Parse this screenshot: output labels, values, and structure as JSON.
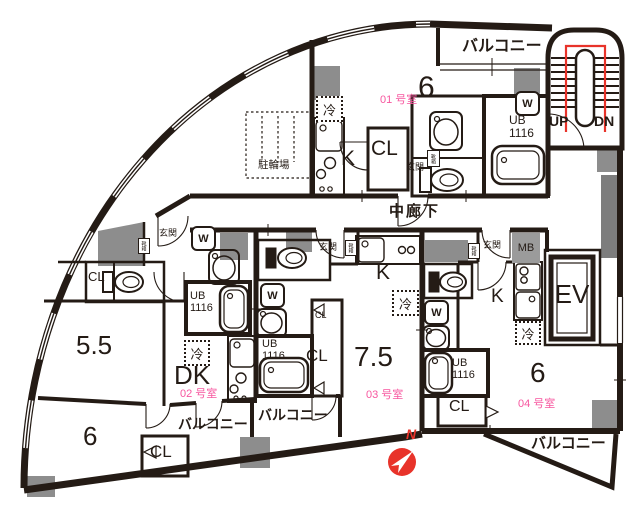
{
  "colors": {
    "wall": "#241b15",
    "gray_pillar": "#8d8d8d",
    "stair_route_red": "#e8332a",
    "compass_red": "#e8332a",
    "room_number_pink": "#f7569f"
  },
  "common_labels": {
    "corridor": "中廊下",
    "bicycle_parking": "駐輪場",
    "elevator": "EV",
    "meter_box": "MB",
    "stairs_up": "UP",
    "stairs_down": "DN",
    "compass_north": "N",
    "balcony": "バルコニー"
  },
  "fixture_labels": {
    "kitchen": "K",
    "closet": "CL",
    "entrance": "玄関",
    "unit_bath": "UB\n1116",
    "washer": "W",
    "fridge": "冷",
    "shoe_box": "靴箱"
  },
  "units": {
    "u01": {
      "number": "01 号室",
      "size": "6"
    },
    "u02": {
      "number": "02 号室",
      "dk": "DK",
      "size_main": "5.5",
      "size_lower": "6"
    },
    "u03": {
      "number": "03 号室",
      "size": "7.5"
    },
    "u04": {
      "number": "04 号室",
      "size": "6"
    }
  }
}
